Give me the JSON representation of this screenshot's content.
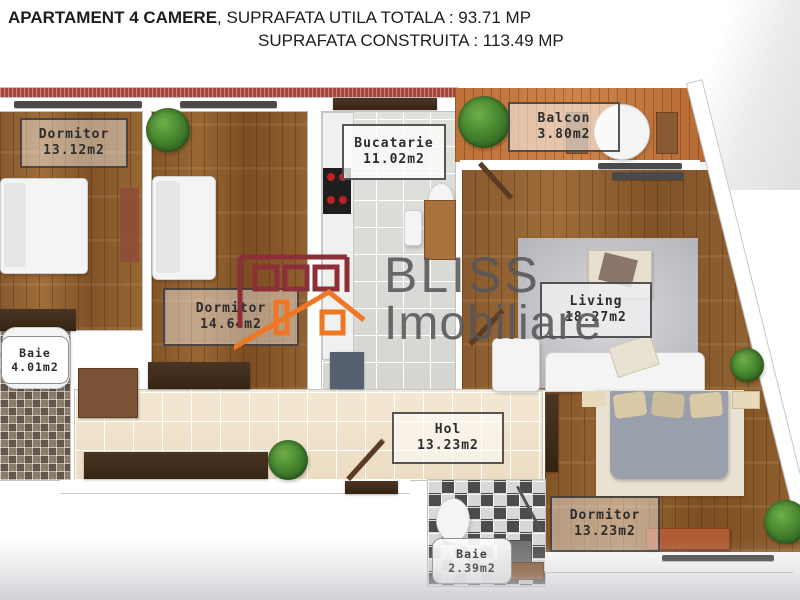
{
  "header": {
    "title_bold": "APARTAMENT 4 CAMERE",
    "title_rest": ", SUPRAFATA UTILA TOTALA : 93.71 MP",
    "line2": "SUPRAFATA CONSTRUITA : 113.49 MP"
  },
  "brand": {
    "name": "BLISS",
    "subtitle": "Imobiliare"
  },
  "rooms": {
    "dormitor1": {
      "name": "Dormitor",
      "area": "13.12m2"
    },
    "dormitor2": {
      "name": "Dormitor",
      "area": "14.64m2"
    },
    "bucatarie": {
      "name": "Bucatarie",
      "area": "11.02m2"
    },
    "balcon": {
      "name": "Balcon",
      "area": "3.80m2"
    },
    "living": {
      "name": "Living",
      "area": "18.27m2"
    },
    "baie1": {
      "name": "Baie",
      "area": "4.01m2"
    },
    "hol": {
      "name": "Hol",
      "area": "13.23m2"
    },
    "dormitor3": {
      "name": "Dormitor",
      "area": "13.23m2"
    },
    "baie2": {
      "name": "Baie",
      "area": "2.39m2"
    }
  },
  "colors": {
    "accent_orange": "#EF7622",
    "brand_maroon": "#8C2F38",
    "wood_floor": "#96663A",
    "deck": "#C5793F",
    "label_text": "#2C2C2C"
  }
}
